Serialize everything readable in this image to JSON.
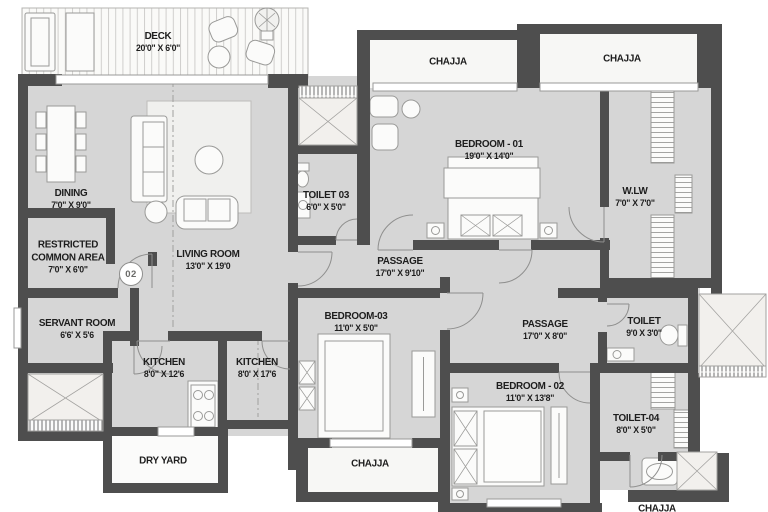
{
  "plan": {
    "unit_badge": "02",
    "colors": {
      "wall": "#4e4e4e",
      "floor": "#d6d6d6",
      "outdoor": "#f7f7f5",
      "outline": "#8f8f8e",
      "text": "#1d1d1d",
      "background": "#ffffff"
    },
    "rooms": {
      "deck": {
        "label": "DECK",
        "dims": "20'0\" X 6'0\""
      },
      "dining": {
        "label": "DINING",
        "dims": "7'0\" X 9'0\""
      },
      "restricted_common_area": {
        "label": "RESTRICTED COMMON AREA",
        "dims": "7'0\" X 6'0\""
      },
      "servant_room": {
        "label": "SERVANT ROOM",
        "dims": "6'6' X 5'6"
      },
      "living_room": {
        "label": "LIVING ROOM",
        "dims": "13'0\" X 19'0"
      },
      "kitchen_1": {
        "label": "KITCHEN",
        "dims": "8'0\" X 12'6"
      },
      "kitchen_2": {
        "label": "KITCHEN",
        "dims": "8'0' X 17'6"
      },
      "dry_yard": {
        "label": "DRY YARD"
      },
      "toilet_03": {
        "label": "TOILET 03",
        "dims": "6'0\" X 5'0\""
      },
      "chajja_top_mid": {
        "label": "CHAJJA"
      },
      "chajja_top_right": {
        "label": "CHAJJA"
      },
      "bedroom_01": {
        "label": "BEDROOM - 01",
        "dims": "19'0\" X 14'0\""
      },
      "wlw": {
        "label": "W.LW",
        "dims": "7'0\" X 7'0\""
      },
      "passage_1": {
        "label": "PASSAGE",
        "dims": "17'0\" X 9'10\""
      },
      "bedroom_03": {
        "label": "BEDROOM-03",
        "dims": "11'0\" X 5'0\""
      },
      "passage_2": {
        "label": "PASSAGE",
        "dims": "17'0\" X 8'0\""
      },
      "toilet": {
        "label": "TOILET",
        "dims": "9'0 X 3'0\""
      },
      "bedroom_02": {
        "label": "BEDROOM - 02",
        "dims": "11'0\" X 13'8\""
      },
      "toilet_04": {
        "label": "TOILET-04",
        "dims": "8'0\" X 5'0\""
      },
      "chajja_bottom_mid": {
        "label": "CHAJJA"
      },
      "chajja_bottom_right": {
        "label": "CHAJJA"
      }
    }
  }
}
